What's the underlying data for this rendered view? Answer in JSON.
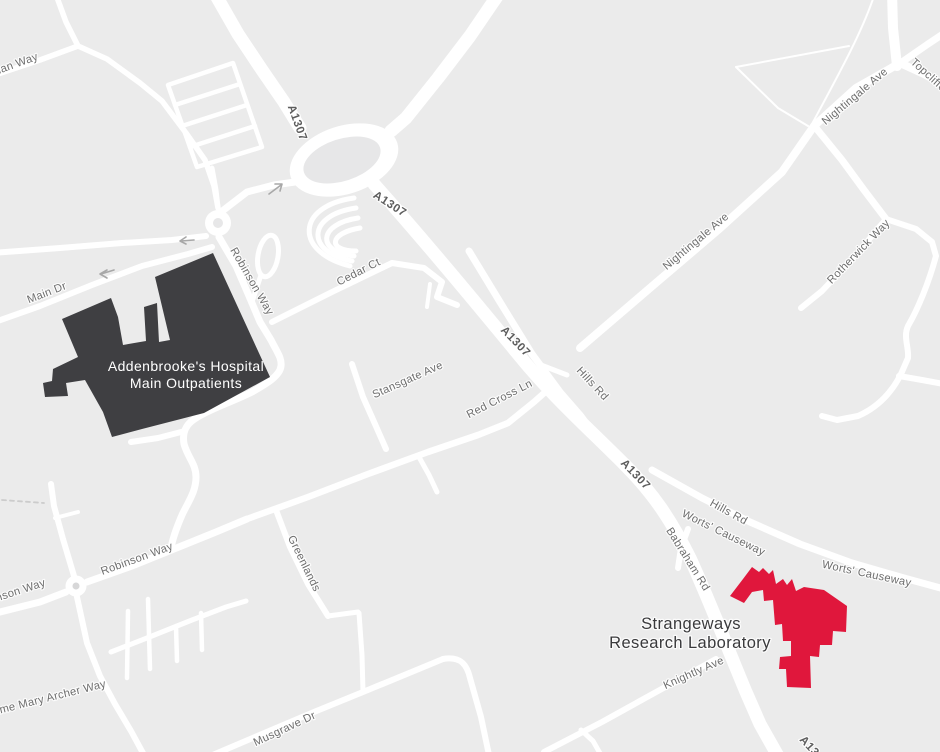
{
  "map": {
    "background_color": "#ebebeb",
    "road_color": "#ffffff",
    "island_color": "#e7e7e8",
    "road_labels": {
      "a1307": "A1307",
      "hills_rd": "Hills Rd",
      "worts_causeway": "Worts' Causeway",
      "babraham_rd": "Babraham Rd",
      "nightingale_ave": "Nightingale Ave",
      "topcliffe_way": "Topcliffe Way",
      "rotherwick_way": "Rotherwick Way",
      "cedar_ct": "Cedar Ct",
      "stansgate_ave": "Stansgate Ave",
      "red_cross_ln": "Red Cross Ln",
      "robinson_way": "Robinson Way",
      "greenlands": "Greenlands",
      "musgrave_dr": "Musgrave Dr",
      "dame_mary_archer_way": "Dame Mary Archer Way",
      "knightly_ave": "Knightly Ave",
      "main_dr": "Main Dr",
      "adrian_way": "Adrian Way"
    },
    "buildings": {
      "hospital": {
        "name_line1": "Addenbrooke's Hospital",
        "name_line2": "Main Outpatients",
        "fill": "#3f3f42",
        "label_color": "#ffffff"
      },
      "strangeways": {
        "name_line1": "Strangeways",
        "name_line2": "Research Laboratory",
        "fill": "#e0173c",
        "label_color": "#3a3a3c"
      }
    }
  }
}
